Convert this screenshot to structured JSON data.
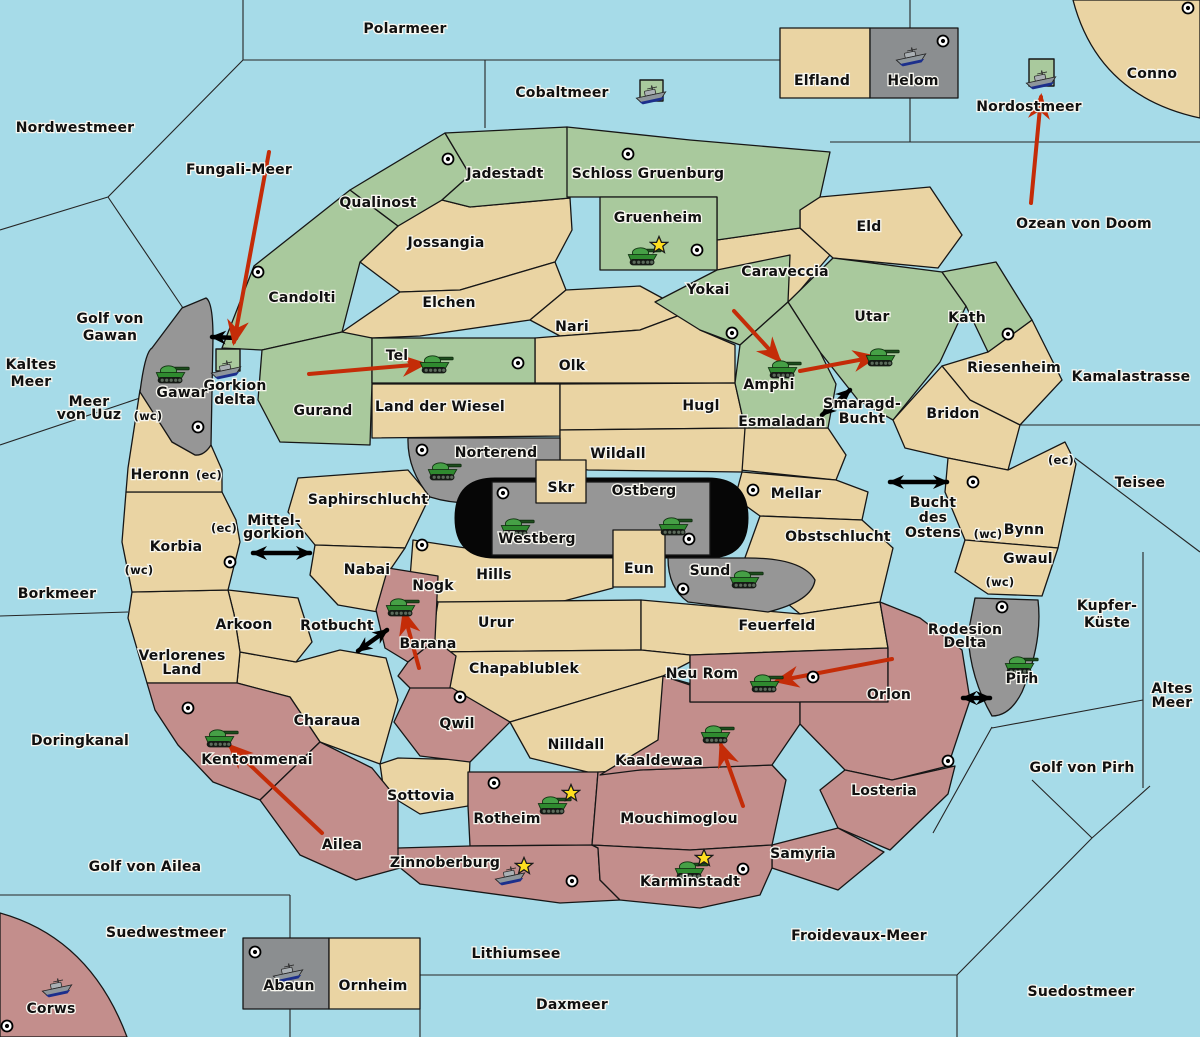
{
  "map": {
    "colors": {
      "sea": "#a6dbe8",
      "land_tan": "#ead4a3",
      "land_green": "#a9c99d",
      "land_pink": "#c38e8c",
      "land_gray": "#969696",
      "center_black": "#060606",
      "attack_arrow": "#c42c08",
      "sea_link": "#000000",
      "star": "#ffdf1f"
    },
    "territories": {
      "green": [
        "Candolti",
        "Qualinost",
        "Jadestadt",
        "Schloss Gruenburg",
        "Gruenheim",
        "Yokai",
        "Utar",
        "Kath",
        "Gurand",
        "Tel",
        "Amphi",
        "Gorkion delta"
      ],
      "tan": [
        "Jossangia",
        "Elchen",
        "Nari",
        "Olk",
        "Caraveccia",
        "Eld",
        "Riesenheim",
        "Bridon",
        "Land der Wiesel",
        "Hugl",
        "Esmaladan",
        "Heronn",
        "Korbia",
        "Saphirschlucht",
        "Nabai",
        "Wildall",
        "Skr",
        "Eun",
        "Mellar",
        "Obstschlucht",
        "Bynn",
        "Gwaul",
        "Hills",
        "Urur",
        "Feuerfeld",
        "Chapablublek",
        "Nilldall",
        "Verlorenes Land",
        "Arkoon",
        "Charaua",
        "Sottovia",
        "Conno",
        "Elfland",
        "Ornheim"
      ],
      "gray": [
        "Gawar",
        "Norterend",
        "Westberg",
        "Ostberg",
        "Sund",
        "Pirh",
        "Helom",
        "Abaun"
      ],
      "pink": [
        "Nogk",
        "Barana",
        "Qwil",
        "Kentommenai",
        "Ailea",
        "Rotheim",
        "Zinnoberburg",
        "Mouchimoglou",
        "Kaaldewaa",
        "Neu Rom",
        "Orlon",
        "Losteria",
        "Samyria",
        "Karminstadt",
        "Corws"
      ]
    },
    "sea_areas": [
      "Polarmeer",
      "Nordwestmeer",
      "Cobaltmeer",
      "Nordostmeer",
      "Ozean von Doom",
      "Fungali-Meer",
      "Kaltes Meer",
      "Golf von Gawan",
      "Meer von Uuz",
      "Borkmeer",
      "Mittel-gorkion",
      "Rotbucht",
      "Doringkanal",
      "Golf von Ailea",
      "Suedwestmeer",
      "Lithiumsee",
      "Daxmeer",
      "Froidevaux-Meer",
      "Suedostmeer",
      "Golf von Pirh",
      "Altes Meer",
      "Kupfer-Küste",
      "Teisee",
      "Kamalastrasse",
      "Bucht des Ostens",
      "Smaragd-Bucht",
      "Rodesion Delta"
    ],
    "labels": [
      {
        "t": "Polarmeer",
        "x": 405,
        "y": 33
      },
      {
        "t": "Nordwestmeer",
        "x": 75,
        "y": 132
      },
      {
        "t": "Cobaltmeer",
        "x": 562,
        "y": 97
      },
      {
        "t": "Nordostmeer",
        "x": 1029,
        "y": 111
      },
      {
        "t": "Conno",
        "x": 1152,
        "y": 78
      },
      {
        "t": "Ozean von Doom",
        "x": 1084,
        "y": 228
      },
      {
        "t": "Fungali-Meer",
        "x": 239,
        "y": 174
      },
      {
        "t": "Kaltes Meer",
        "x": 31,
        "y": 369,
        "lines": [
          "Kaltes",
          "Meer"
        ],
        "lh": 17
      },
      {
        "t": "Golf von Gawan",
        "x": 110,
        "y": 323,
        "lines": [
          "Golf von",
          "Gawan"
        ],
        "lh": 17
      },
      {
        "t": "Meer von Uuz",
        "x": 89,
        "y": 406,
        "lines": [
          "Meer",
          "von Uuz"
        ],
        "lh": 13
      },
      {
        "t": "(wc)",
        "x": 148,
        "y": 420,
        "s": 1
      },
      {
        "t": "Borkmeer",
        "x": 57,
        "y": 598
      },
      {
        "t": "Mittel-gorkion",
        "x": 274,
        "y": 525,
        "lines": [
          "Mittel-",
          "gorkion"
        ],
        "lh": 13
      },
      {
        "t": "Rotbucht",
        "x": 337,
        "y": 630
      },
      {
        "t": "Doringkanal",
        "x": 80,
        "y": 745
      },
      {
        "t": "Golf von Ailea",
        "x": 145,
        "y": 871
      },
      {
        "t": "Suedwestmeer",
        "x": 166,
        "y": 937
      },
      {
        "t": "Lithiumsee",
        "x": 516,
        "y": 958
      },
      {
        "t": "Daxmeer",
        "x": 572,
        "y": 1009
      },
      {
        "t": "Froidevaux-Meer",
        "x": 859,
        "y": 940
      },
      {
        "t": "Suedostmeer",
        "x": 1081,
        "y": 996
      },
      {
        "t": "Golf von Pirh",
        "x": 1082,
        "y": 772
      },
      {
        "t": "Altes Meer",
        "x": 1172,
        "y": 693,
        "lines": [
          "Altes",
          "Meer"
        ],
        "lh": 14
      },
      {
        "t": "Kupfer-Küste",
        "x": 1107,
        "y": 610,
        "lines": [
          "Kupfer-",
          "Küste"
        ],
        "lh": 17
      },
      {
        "t": "Teisee",
        "x": 1140,
        "y": 487
      },
      {
        "t": "Kamalastrasse",
        "x": 1131,
        "y": 381
      },
      {
        "t": "Bucht des Ostens",
        "x": 933,
        "y": 507,
        "lines": [
          "Bucht",
          "des",
          "Ostens"
        ],
        "lh": 15
      },
      {
        "t": "Smaragd-Bucht",
        "x": 862,
        "y": 408,
        "lines": [
          "Smaragd-",
          "Bucht"
        ],
        "lh": 15
      },
      {
        "t": "Rodesion Delta",
        "x": 965,
        "y": 634,
        "lines": [
          "Rodesion",
          "Delta"
        ],
        "lh": 13
      },
      {
        "t": "Gorkion delta",
        "x": 235,
        "y": 390,
        "lines": [
          "Gorkion",
          "delta"
        ],
        "lh": 14
      },
      {
        "t": "Qualinost",
        "x": 378,
        "y": 207
      },
      {
        "t": "Jadestadt",
        "x": 505,
        "y": 178
      },
      {
        "t": "Schloss Gruenburg",
        "x": 648,
        "y": 178
      },
      {
        "t": "Gruenheim",
        "x": 658,
        "y": 222
      },
      {
        "t": "Caraveccia",
        "x": 785,
        "y": 276
      },
      {
        "t": "Eld",
        "x": 869,
        "y": 231
      },
      {
        "t": "Jossangia",
        "x": 446,
        "y": 247
      },
      {
        "t": "Candolti",
        "x": 302,
        "y": 302
      },
      {
        "t": "Elchen",
        "x": 449,
        "y": 307
      },
      {
        "t": "Nari",
        "x": 572,
        "y": 331
      },
      {
        "t": "Olk",
        "x": 572,
        "y": 370
      },
      {
        "t": "Yokai",
        "x": 708,
        "y": 294
      },
      {
        "t": "Utar",
        "x": 872,
        "y": 321
      },
      {
        "t": "Kath",
        "x": 967,
        "y": 322
      },
      {
        "t": "Riesenheim",
        "x": 1014,
        "y": 372
      },
      {
        "t": "Bridon",
        "x": 953,
        "y": 418
      },
      {
        "t": "Amphi",
        "x": 769,
        "y": 389
      },
      {
        "t": "Esmaladan",
        "x": 782,
        "y": 426
      },
      {
        "t": "Hugl",
        "x": 701,
        "y": 410
      },
      {
        "t": "Land der Wiesel",
        "x": 440,
        "y": 411
      },
      {
        "t": "Gurand",
        "x": 323,
        "y": 415
      },
      {
        "t": "Tel",
        "x": 397,
        "y": 360
      },
      {
        "t": "Gawar",
        "x": 182,
        "y": 397
      },
      {
        "t": "Heronn",
        "x": 160,
        "y": 479
      },
      {
        "t": "(ec)",
        "x": 209,
        "y": 479,
        "s": 1
      },
      {
        "t": "Saphirschlucht",
        "x": 368,
        "y": 504
      },
      {
        "t": "Korbia",
        "x": 176,
        "y": 551
      },
      {
        "t": "(ec)",
        "x": 224,
        "y": 532,
        "s": 1
      },
      {
        "t": "(wc)",
        "x": 139,
        "y": 574,
        "s": 1
      },
      {
        "t": "Nabai",
        "x": 367,
        "y": 574
      },
      {
        "t": "Mellar",
        "x": 796,
        "y": 498
      },
      {
        "t": "Obstschlucht",
        "x": 838,
        "y": 541
      },
      {
        "t": "Wildall",
        "x": 618,
        "y": 458
      },
      {
        "t": "Norterend",
        "x": 496,
        "y": 457
      },
      {
        "t": "Skr",
        "x": 561,
        "y": 492
      },
      {
        "t": "Ostberg",
        "x": 644,
        "y": 495
      },
      {
        "t": "Westberg",
        "x": 537,
        "y": 543
      },
      {
        "t": "Eun",
        "x": 639,
        "y": 573
      },
      {
        "t": "Sund",
        "x": 710,
        "y": 575
      },
      {
        "t": "Hills",
        "x": 494,
        "y": 579
      },
      {
        "t": "Urur",
        "x": 496,
        "y": 627
      },
      {
        "t": "Feuerfeld",
        "x": 777,
        "y": 630
      },
      {
        "t": "Neu Rom",
        "x": 702,
        "y": 678
      },
      {
        "t": "Orlon",
        "x": 889,
        "y": 699
      },
      {
        "t": "Bynn",
        "x": 1024,
        "y": 534
      },
      {
        "t": "(wc)",
        "x": 988,
        "y": 538,
        "s": 1
      },
      {
        "t": "(ec)",
        "x": 1061,
        "y": 464,
        "s": 1
      },
      {
        "t": "Gwaul",
        "x": 1028,
        "y": 563
      },
      {
        "t": "(wc)",
        "x": 1000,
        "y": 586,
        "s": 1
      },
      {
        "t": "Pirh",
        "x": 1022,
        "y": 683
      },
      {
        "t": "Nogk",
        "x": 433,
        "y": 590
      },
      {
        "t": "Barana",
        "x": 428,
        "y": 648
      },
      {
        "t": "Chapablublek",
        "x": 524,
        "y": 673
      },
      {
        "t": "Nilldall",
        "x": 576,
        "y": 749
      },
      {
        "t": "Kaaldewaa",
        "x": 659,
        "y": 765
      },
      {
        "t": "Qwil",
        "x": 457,
        "y": 728
      },
      {
        "t": "Sottovia",
        "x": 421,
        "y": 800
      },
      {
        "t": "Charaua",
        "x": 327,
        "y": 725
      },
      {
        "t": "Verlorenes Land",
        "x": 182,
        "y": 660,
        "lines": [
          "Verlorenes",
          "Land"
        ],
        "lh": 14
      },
      {
        "t": "Arkoon",
        "x": 244,
        "y": 629
      },
      {
        "t": "Kentommenai",
        "x": 257,
        "y": 764
      },
      {
        "t": "Ailea",
        "x": 342,
        "y": 849
      },
      {
        "t": "Rotheim",
        "x": 507,
        "y": 823
      },
      {
        "t": "Zinnoberburg",
        "x": 445,
        "y": 867
      },
      {
        "t": "Mouchimoglou",
        "x": 679,
        "y": 823
      },
      {
        "t": "Karminstadt",
        "x": 690,
        "y": 886
      },
      {
        "t": "Samyria",
        "x": 803,
        "y": 858
      },
      {
        "t": "Losteria",
        "x": 884,
        "y": 795
      },
      {
        "t": "Elfland",
        "x": 822,
        "y": 85
      },
      {
        "t": "Helom",
        "x": 913,
        "y": 85
      },
      {
        "t": "Abaun",
        "x": 289,
        "y": 990
      },
      {
        "t": "Ornheim",
        "x": 373,
        "y": 990
      },
      {
        "t": "Corws",
        "x": 51,
        "y": 1013
      }
    ],
    "islands": [
      {
        "name": "cobaltmeer-island",
        "x": 640,
        "y": 80,
        "w": 23,
        "h": 21
      },
      {
        "name": "nordostmeer-island",
        "x": 1029,
        "y": 59,
        "w": 25,
        "h": 27
      },
      {
        "name": "gorkion-delta-island",
        "x": 216,
        "y": 349,
        "w": 24,
        "h": 22
      }
    ],
    "units": [
      {
        "type": "tank",
        "x": 645,
        "y": 255
      },
      {
        "type": "tank",
        "x": 437,
        "y": 363
      },
      {
        "type": "tank",
        "x": 785,
        "y": 368
      },
      {
        "type": "tank",
        "x": 883,
        "y": 356
      },
      {
        "type": "tank",
        "x": 173,
        "y": 373
      },
      {
        "type": "tank",
        "x": 445,
        "y": 470
      },
      {
        "type": "tank",
        "x": 518,
        "y": 526
      },
      {
        "type": "tank",
        "x": 676,
        "y": 525
      },
      {
        "type": "tank",
        "x": 747,
        "y": 578
      },
      {
        "type": "tank",
        "x": 403,
        "y": 606
      },
      {
        "type": "tank",
        "x": 767,
        "y": 682
      },
      {
        "type": "tank",
        "x": 718,
        "y": 733
      },
      {
        "type": "tank",
        "x": 222,
        "y": 737
      },
      {
        "type": "tank",
        "x": 555,
        "y": 804
      },
      {
        "type": "tank",
        "x": 692,
        "y": 869
      },
      {
        "type": "tank",
        "x": 1022,
        "y": 664
      },
      {
        "type": "ship",
        "x": 651,
        "y": 95
      },
      {
        "type": "ship",
        "x": 911,
        "y": 57
      },
      {
        "type": "ship",
        "x": 1041,
        "y": 80
      },
      {
        "type": "ship",
        "x": 226,
        "y": 370
      },
      {
        "type": "ship",
        "x": 510,
        "y": 876
      },
      {
        "type": "ship",
        "x": 288,
        "y": 973
      },
      {
        "type": "ship",
        "x": 57,
        "y": 988
      }
    ],
    "capital_dots": [
      {
        "x": 448,
        "y": 159
      },
      {
        "x": 628,
        "y": 154
      },
      {
        "x": 1188,
        "y": 8
      },
      {
        "x": 943,
        "y": 41
      },
      {
        "x": 258,
        "y": 272
      },
      {
        "x": 697,
        "y": 250
      },
      {
        "x": 732,
        "y": 333
      },
      {
        "x": 1008,
        "y": 334
      },
      {
        "x": 518,
        "y": 363
      },
      {
        "x": 198,
        "y": 427
      },
      {
        "x": 422,
        "y": 450
      },
      {
        "x": 503,
        "y": 493
      },
      {
        "x": 689,
        "y": 539
      },
      {
        "x": 753,
        "y": 490
      },
      {
        "x": 230,
        "y": 562
      },
      {
        "x": 973,
        "y": 482
      },
      {
        "x": 683,
        "y": 589
      },
      {
        "x": 422,
        "y": 545
      },
      {
        "x": 460,
        "y": 697
      },
      {
        "x": 813,
        "y": 677
      },
      {
        "x": 188,
        "y": 708
      },
      {
        "x": 948,
        "y": 761
      },
      {
        "x": 1002,
        "y": 607
      },
      {
        "x": 494,
        "y": 783
      },
      {
        "x": 572,
        "y": 881
      },
      {
        "x": 743,
        "y": 869
      },
      {
        "x": 7,
        "y": 1026
      },
      {
        "x": 255,
        "y": 952
      }
    ],
    "stars": [
      {
        "x": 659,
        "y": 245
      },
      {
        "x": 571,
        "y": 793
      },
      {
        "x": 524,
        "y": 866
      },
      {
        "x": 704,
        "y": 858
      }
    ],
    "attack_arrows": [
      {
        "x1": 269,
        "y1": 152,
        "x2": 234,
        "y2": 342
      },
      {
        "x1": 309,
        "y1": 374,
        "x2": 424,
        "y2": 364
      },
      {
        "x1": 734,
        "y1": 311,
        "x2": 779,
        "y2": 360
      },
      {
        "x1": 800,
        "y1": 371,
        "x2": 875,
        "y2": 357
      },
      {
        "x1": 1031,
        "y1": 203,
        "x2": 1041,
        "y2": 97
      },
      {
        "x1": 419,
        "y1": 668,
        "x2": 404,
        "y2": 613
      },
      {
        "x1": 892,
        "y1": 659,
        "x2": 777,
        "y2": 681
      },
      {
        "x1": 743,
        "y1": 806,
        "x2": 721,
        "y2": 745
      },
      {
        "x1": 322,
        "y1": 833,
        "x2": 230,
        "y2": 746
      }
    ],
    "sea_links": [
      {
        "x1": 253,
        "y1": 553,
        "x2": 310,
        "y2": 553,
        "двух": true,
        "two": true
      },
      {
        "x1": 358,
        "y1": 651,
        "x2": 387,
        "y2": 630,
        "two": true
      },
      {
        "x1": 822,
        "y1": 415,
        "x2": 850,
        "y2": 390,
        "two": true
      },
      {
        "x1": 890,
        "y1": 482,
        "x2": 947,
        "y2": 482,
        "two": true
      },
      {
        "x1": 963,
        "y1": 698,
        "x2": 990,
        "y2": 698,
        "two": true
      },
      {
        "x1": 236,
        "y1": 338,
        "x2": 212,
        "y2": 337,
        "two": false
      }
    ]
  }
}
